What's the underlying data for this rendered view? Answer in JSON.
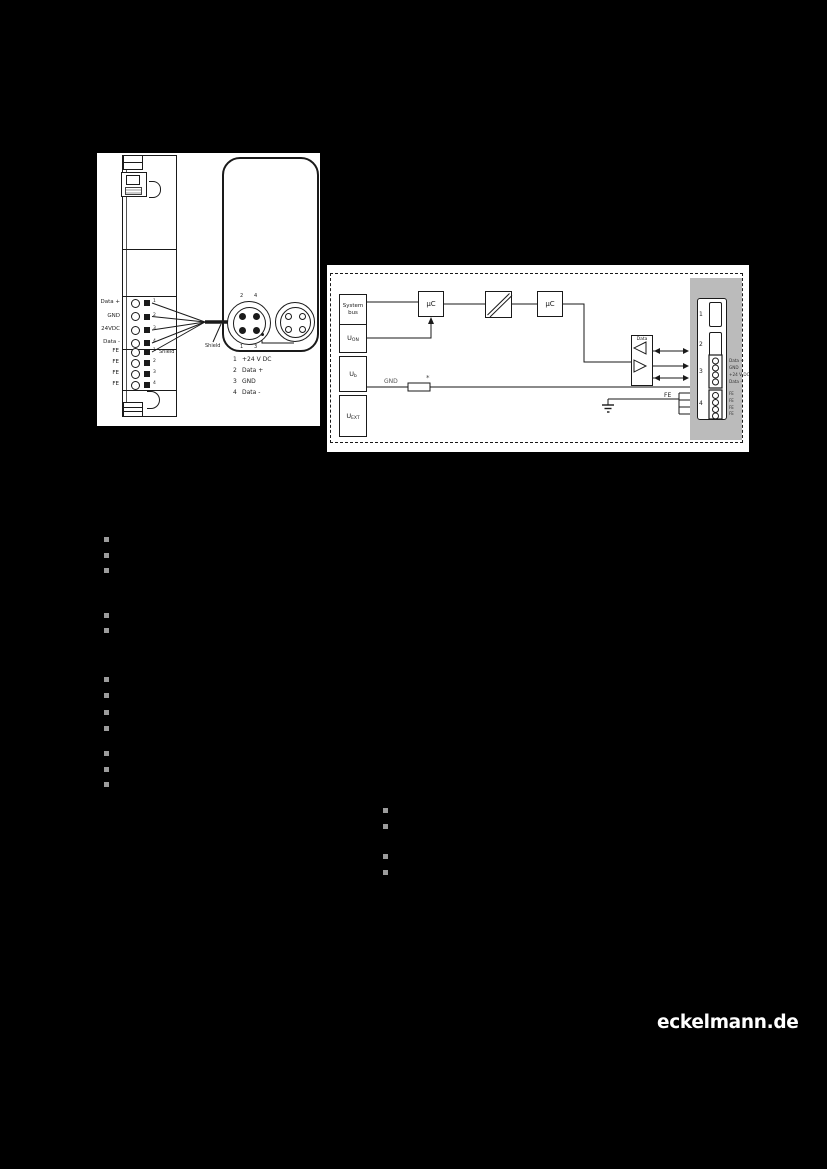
{
  "logo": "eckelmann.de",
  "wiring_figure": {
    "terminals": [
      "Data +",
      "GND",
      "24VDC",
      "Data -"
    ],
    "terminal_numbers": [
      "1",
      "2",
      "3",
      "4"
    ],
    "fe_terminals": [
      "FE",
      "FE",
      "FE",
      "FE"
    ],
    "fe_numbers": [
      "1",
      "2",
      "3",
      "4"
    ],
    "shield_module": "Shield",
    "shield_cable": "Shield",
    "pins": {
      "top_left": "2",
      "top_right": "4",
      "bottom_left": "1",
      "bottom_right": "3"
    },
    "legend": [
      {
        "pin": "1",
        "label": "+24 V DC"
      },
      {
        "pin": "2",
        "label": "Data +"
      },
      {
        "pin": "3",
        "label": "GND"
      },
      {
        "pin": "4",
        "label": "Data -"
      }
    ]
  },
  "block_diagram": {
    "system_bus": "System bus",
    "u_on": {
      "base": "U",
      "sub": "ON"
    },
    "u_b": {
      "base": "U",
      "sub": "b"
    },
    "u_ext": {
      "base": "U",
      "sub": "EXT"
    },
    "uc_left": "µC",
    "uc_right": "µC",
    "data_driver": "Data",
    "gnd_label": "GND",
    "fuse_mark": "*",
    "fe_label": "FE",
    "connector": {
      "numbers": [
        "1",
        "2",
        "3",
        "4"
      ],
      "signal_labels": [
        "Data +",
        "GND",
        "+24 V DC",
        "Data -"
      ],
      "fe_labels": [
        "FE",
        "FE",
        "FE",
        "FE"
      ]
    }
  },
  "colors": {
    "page_bg": "#000000",
    "figure_bg": "#ffffff",
    "line": "#1a1a1a",
    "gnd_line": "#8a8a8a",
    "panel_gray": "#bbbbbb",
    "bullet_gray": "#9c9c9c"
  }
}
